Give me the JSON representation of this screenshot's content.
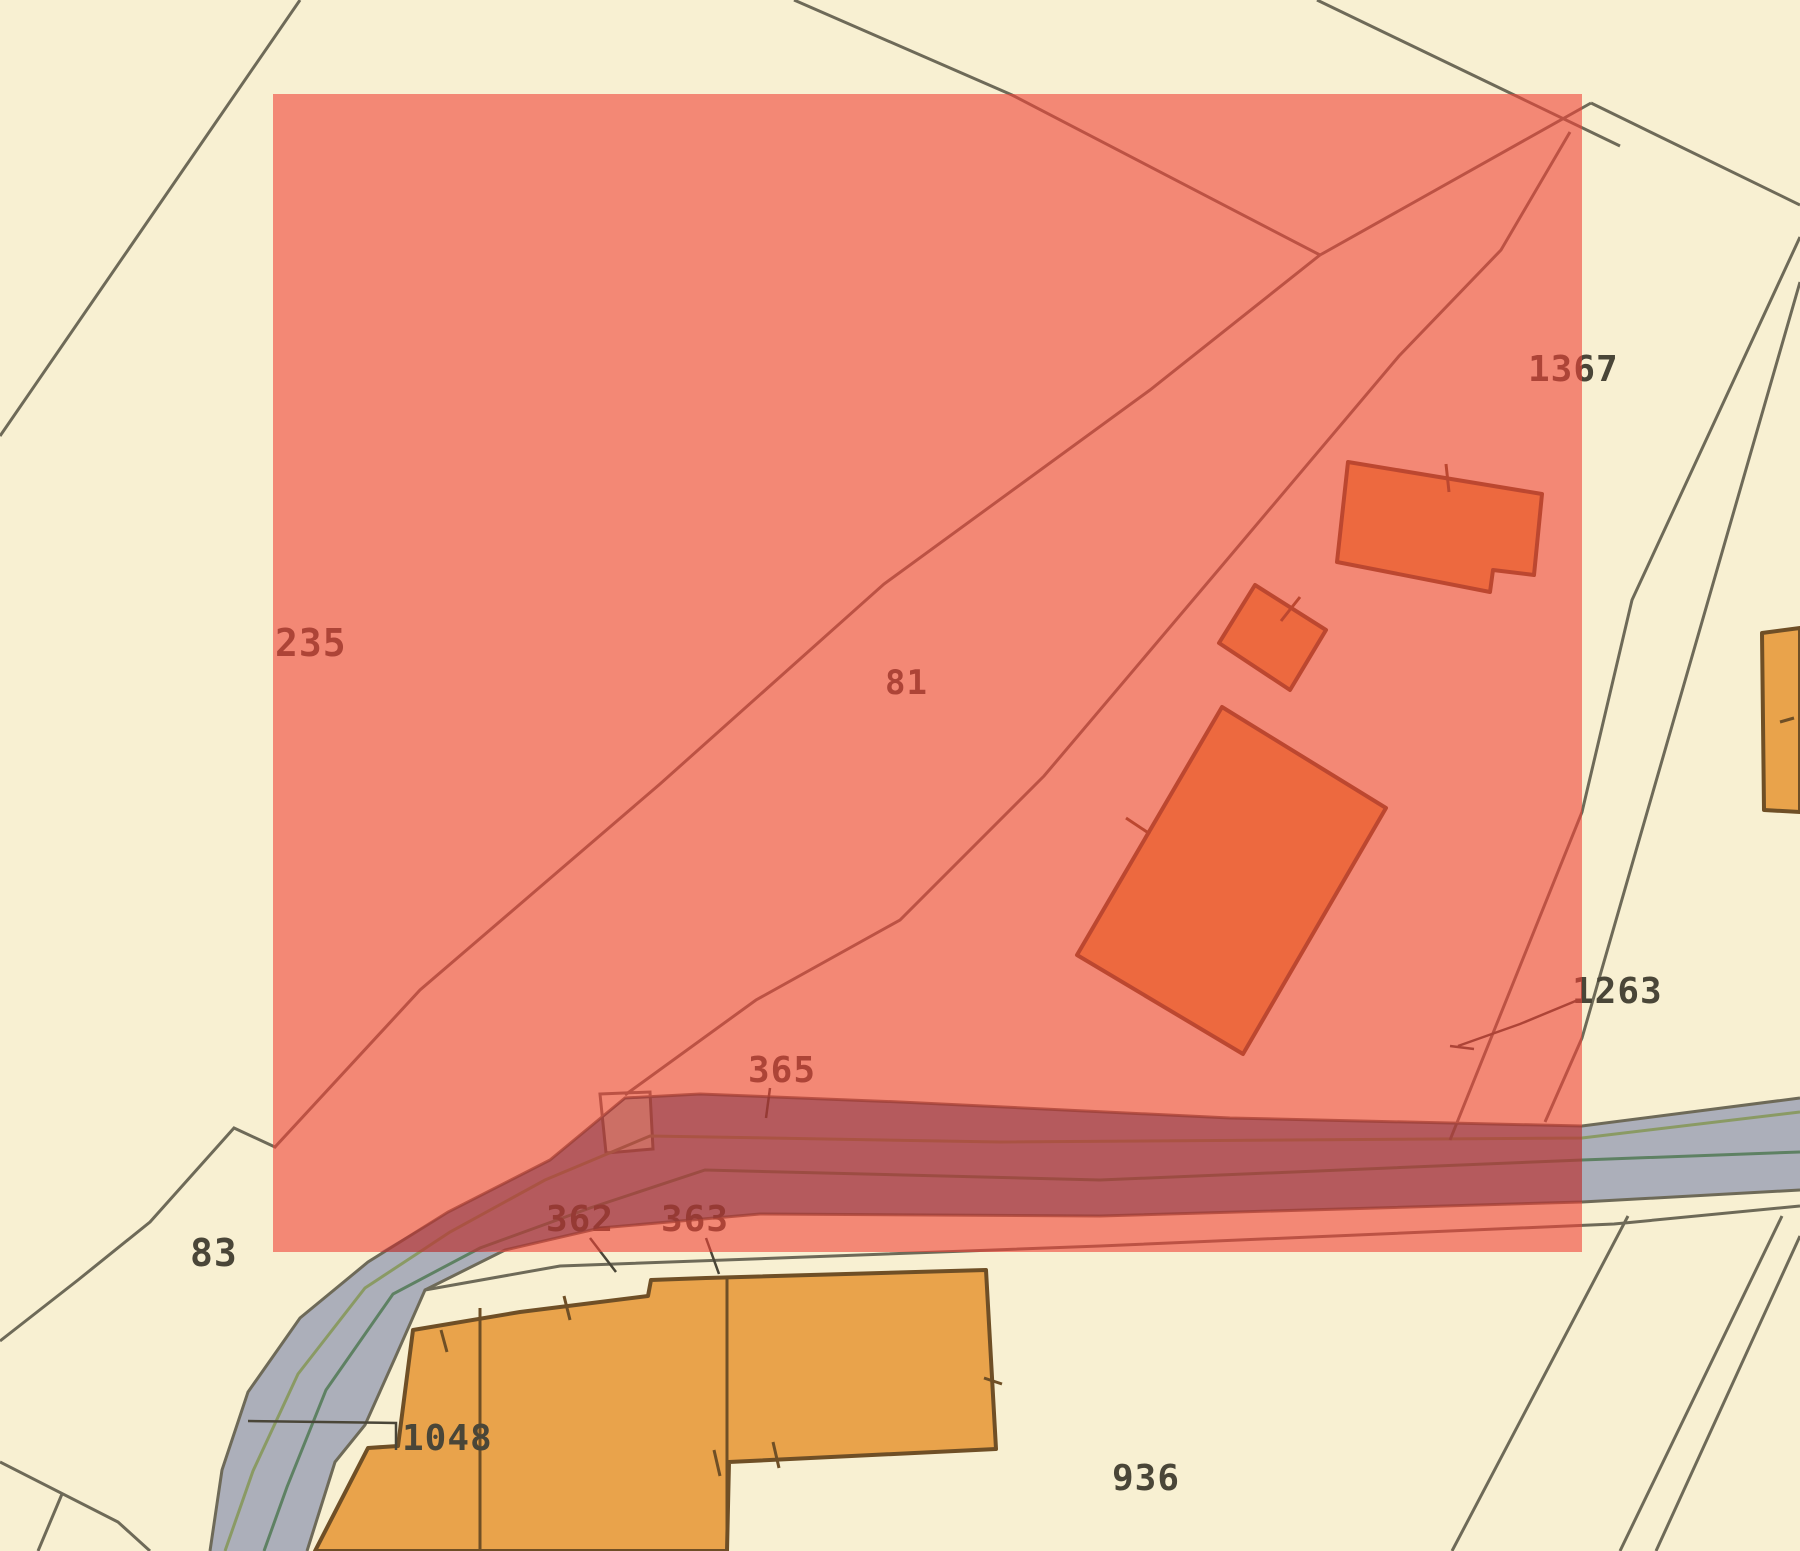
{
  "map": {
    "description": "Cadastral parcel map with semi-transparent red selection rectangle",
    "selection_overlay": {
      "x1": 273,
      "y1": 94,
      "x2": 1582,
      "y2": 1252,
      "color": "#f04337",
      "opacity": 0.6
    },
    "palette": {
      "background": "#f8f0d2",
      "parcel_line": "#6e6a58",
      "road_fill": "#acafba",
      "road_green_line": "#5e8163",
      "road_green_line_light": "#8a9a64",
      "building_fill": "#e9a34b",
      "building_outline": "#6f4f26",
      "label_color": "#4a4638",
      "selection_color": "#f04337"
    },
    "labels": {
      "n235": {
        "text": "235"
      },
      "n81": {
        "text": "81"
      },
      "n1367": {
        "text": "1367"
      },
      "n1263": {
        "text": "1263"
      },
      "n365": {
        "text": "365"
      },
      "n362": {
        "text": "362"
      },
      "n363": {
        "text": "363"
      },
      "n83": {
        "text": "83"
      },
      "n1048": {
        "text": "1048"
      },
      "n936": {
        "text": "936"
      }
    }
  }
}
